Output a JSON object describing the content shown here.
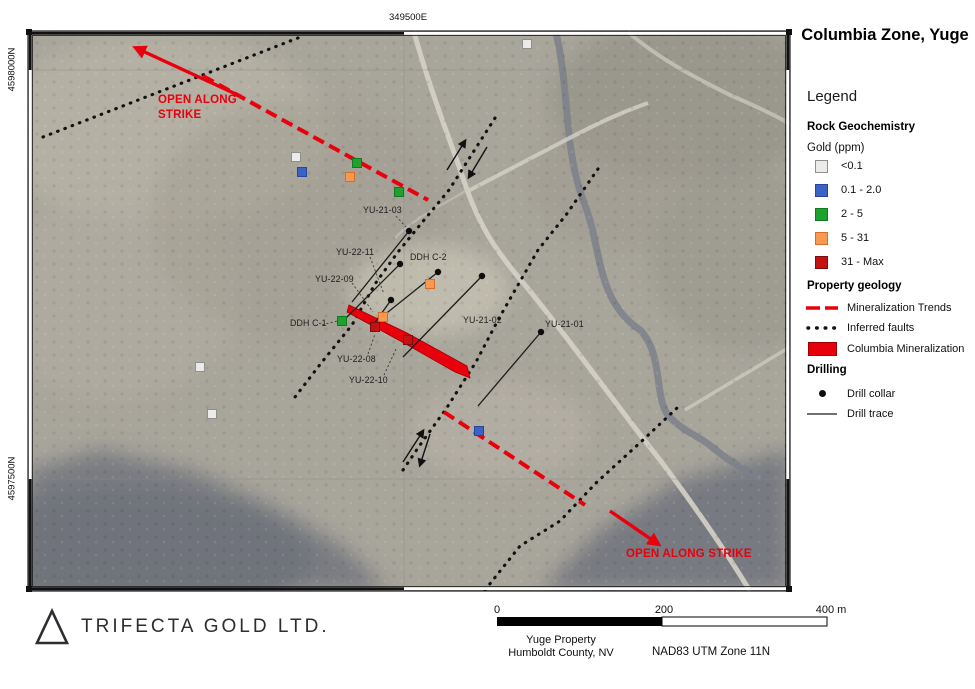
{
  "title": "Columbia Zone, Yuge",
  "colors": {
    "annotation_red": "#e8000d"
  },
  "map": {
    "grid_labels": {
      "easting_top": "349500E",
      "northing_upper": "4598000N",
      "northing_lower": "4597500N"
    },
    "open_along_strike_upper": "OPEN ALONG STRIKE",
    "open_along_strike_lower": "OPEN ALONG STRIKE",
    "labels": [
      {
        "text": "YU-21-03",
        "x": 363,
        "y": 205
      },
      {
        "text": "YU-22-11",
        "x": 336,
        "y": 247
      },
      {
        "text": "DDH C-2",
        "x": 410,
        "y": 252
      },
      {
        "text": "YU-22-09",
        "x": 315,
        "y": 274
      },
      {
        "text": "DDH C-1",
        "x": 290,
        "y": 318
      },
      {
        "text": "YU-21-02",
        "x": 463,
        "y": 315
      },
      {
        "text": "YU-21-01",
        "x": 545,
        "y": 319
      },
      {
        "text": "YU-22-08",
        "x": 337,
        "y": 354
      },
      {
        "text": "YU-22-10",
        "x": 349,
        "y": 375
      }
    ],
    "leaders": [
      [
        396,
        216,
        406,
        227
      ],
      [
        370,
        257,
        384,
        294
      ],
      [
        352,
        283,
        373,
        312
      ],
      [
        322,
        325,
        337,
        321
      ],
      [
        368,
        354,
        375,
        334
      ],
      [
        384,
        375,
        396,
        349
      ]
    ],
    "drill_collars": [
      [
        409,
        231
      ],
      [
        400,
        264
      ],
      [
        438,
        272
      ],
      [
        482,
        276
      ],
      [
        391,
        300
      ],
      [
        541,
        332
      ]
    ],
    "drill_traces": [
      [
        409,
        231,
        352,
        302
      ],
      [
        400,
        264,
        346,
        318
      ],
      [
        438,
        272,
        383,
        316
      ],
      [
        482,
        276,
        403,
        357
      ],
      [
        391,
        300,
        371,
        328
      ],
      [
        541,
        332,
        478,
        406
      ]
    ],
    "samples": [
      {
        "c": "lt01",
        "x": 296,
        "y": 157
      },
      {
        "c": "lt01",
        "x": 527,
        "y": 44
      },
      {
        "c": "lt01",
        "x": 200,
        "y": 367
      },
      {
        "c": "lt01",
        "x": 212,
        "y": 414
      },
      {
        "c": "b",
        "x": 302,
        "y": 172
      },
      {
        "c": "b",
        "x": 479,
        "y": 431
      },
      {
        "c": "g",
        "x": 357,
        "y": 163
      },
      {
        "c": "g",
        "x": 399,
        "y": 192
      },
      {
        "c": "g",
        "x": 342,
        "y": 321
      },
      {
        "c": "o",
        "x": 350,
        "y": 177
      },
      {
        "c": "o",
        "x": 430,
        "y": 284
      },
      {
        "c": "o",
        "x": 383,
        "y": 317
      },
      {
        "c": "r",
        "x": 375,
        "y": 327
      },
      {
        "c": "r",
        "x": 408,
        "y": 340
      }
    ],
    "faults": [
      [
        [
          43,
          137
        ],
        [
          303,
          36
        ]
      ],
      [
        [
          495,
          118
        ],
        [
          449,
          190
        ],
        [
          420,
          225
        ],
        [
          398,
          252
        ],
        [
          375,
          284
        ],
        [
          352,
          325
        ],
        [
          322,
          362
        ],
        [
          295,
          397
        ]
      ],
      [
        [
          403,
          470
        ],
        [
          420,
          445
        ],
        [
          446,
          409
        ],
        [
          476,
          362
        ],
        [
          498,
          320
        ],
        [
          538,
          250
        ],
        [
          566,
          215
        ],
        [
          600,
          166
        ]
      ],
      [
        [
          485,
          590
        ],
        [
          520,
          546
        ],
        [
          560,
          521
        ],
        [
          596,
          483
        ],
        [
          643,
          440
        ],
        [
          677,
          408
        ]
      ]
    ],
    "trends": [
      [
        203,
        76,
        428,
        200
      ],
      [
        444,
        412,
        585,
        505
      ]
    ],
    "trend_arrows": [
      {
        "from": [
          240,
          96
        ],
        "to": [
          136,
          48
        ]
      },
      {
        "from": [
          610,
          511
        ],
        "to": [
          658,
          544
        ]
      }
    ],
    "fault_arrows": [
      {
        "from": [
          447,
          170
        ],
        "to": [
          465,
          141
        ]
      },
      {
        "from": [
          487,
          147
        ],
        "to": [
          469,
          177
        ]
      },
      {
        "from": [
          403,
          462
        ],
        "to": [
          423,
          431
        ]
      },
      {
        "from": [
          430,
          434
        ],
        "to": [
          420,
          465
        ]
      }
    ],
    "mineralization_polygon": "349,305 407,333 467,366 470,378 455,372 404,343 347,312"
  },
  "legend": {
    "heading": "Legend",
    "rock_geochem_heading": "Rock Geochemistry",
    "gold_unit_label": "Gold (ppm)",
    "gold_items": [
      {
        "key": "lt01",
        "label": "<0.1"
      },
      {
        "key": "b",
        "label": "0.1 - 2.0"
      },
      {
        "key": "g",
        "label": "2 - 5"
      },
      {
        "key": "o",
        "label": "5 - 31"
      },
      {
        "key": "r",
        "label": "31 - Max"
      }
    ],
    "gold_colors": {
      "lt01": {
        "fill": "#ebebe7",
        "stroke": "#8f8f8f"
      },
      "b": {
        "fill": "#3b63c4",
        "stroke": "#27459c"
      },
      "g": {
        "fill": "#1ea22d",
        "stroke": "#127a1e"
      },
      "o": {
        "fill": "#f79a50",
        "stroke": "#d86a2a"
      },
      "r": {
        "fill": "#c31212",
        "stroke": "#7e0c0c"
      }
    },
    "property_geology_heading": "Property geology",
    "geology_items": {
      "trends": "Mineralization Trends",
      "faults": "Inferred faults",
      "mineralization": "Columbia Mineralization"
    },
    "drilling_heading": "Drilling",
    "drilling_items": {
      "collar": "Drill collar",
      "trace": "Drill trace"
    }
  },
  "footer": {
    "company": "TRIFECTA GOLD LTD.",
    "scale": {
      "start": "0",
      "mid": "200",
      "end": "400 m"
    },
    "property_line1": "Yuge Property",
    "property_line2": "Humboldt County, NV",
    "datum": "NAD83 UTM Zone 11N"
  }
}
